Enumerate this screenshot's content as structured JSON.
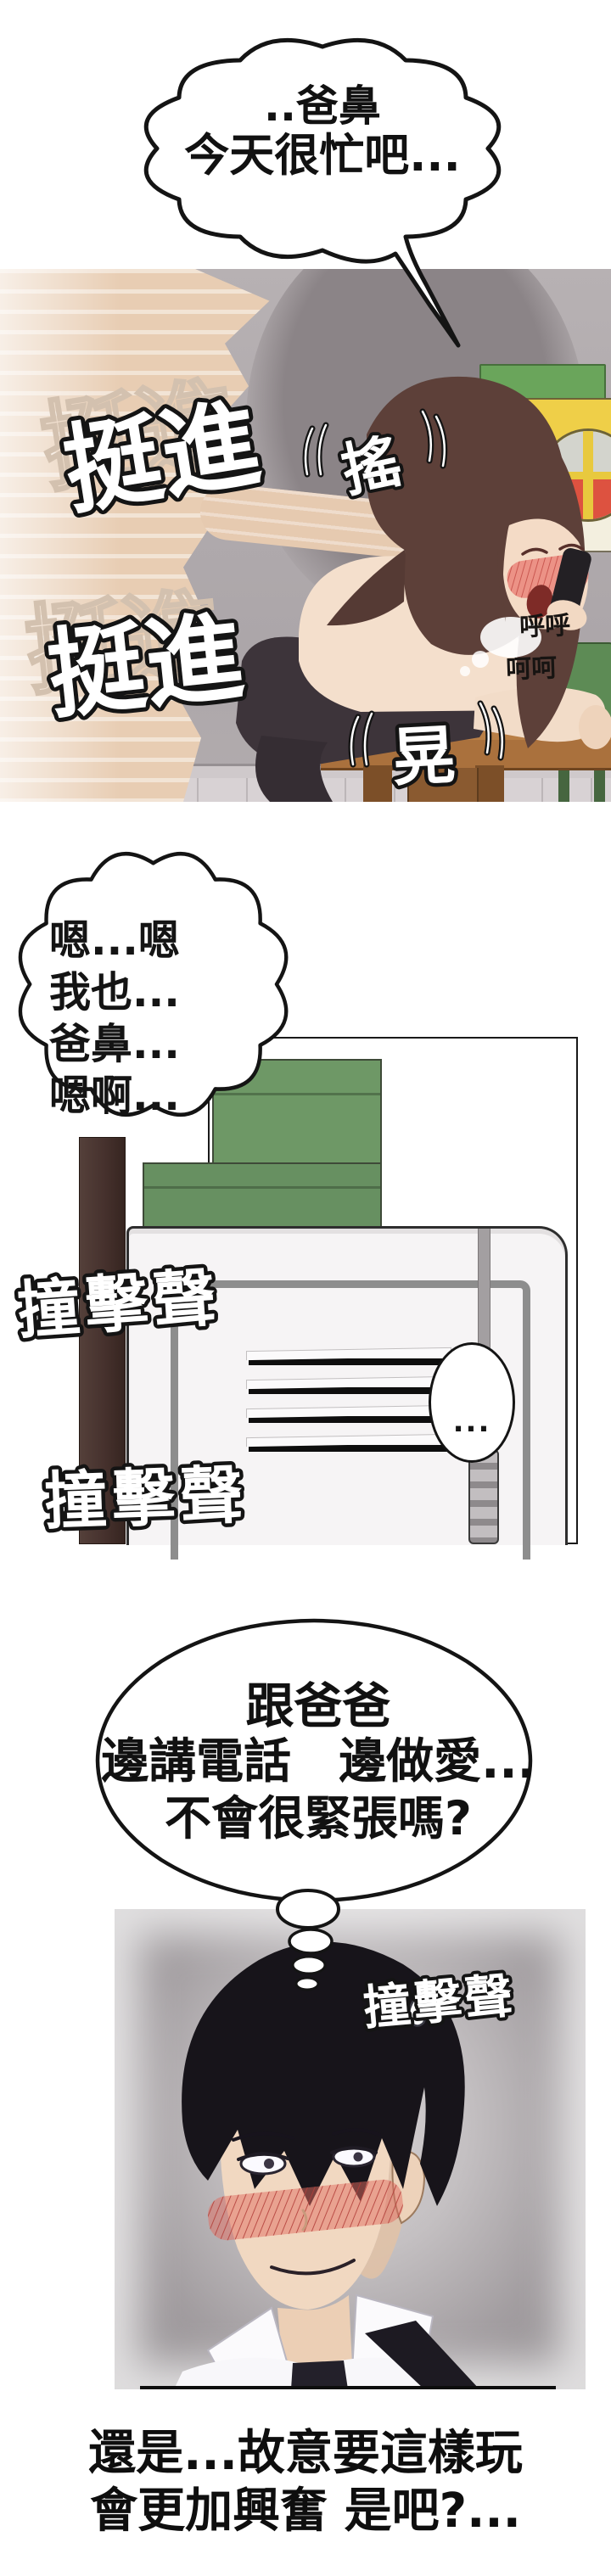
{
  "type": "comic-page",
  "bubbles": {
    "speech_top": {
      "line1": "..爸鼻",
      "line2": "今天很忙吧..."
    },
    "speech_moan": {
      "line1": "嗯...嗯",
      "line2": "我也...",
      "line3": "爸鼻...",
      "line4": "嗯啊..."
    },
    "ellipsis_oval": {
      "text": "..."
    },
    "thought": {
      "line1": "跟爸爸",
      "line2": "邊講電話　邊做愛...",
      "line3": "不會很緊張嗎?"
    }
  },
  "sfx": {
    "thrust_1": "挺進",
    "thrust_2": "挺進",
    "shake": "搖",
    "sway": "晃",
    "pant_soft_1": "呼呼",
    "pant_soft_2": "呵呵",
    "bang_1": "撞擊聲",
    "bang_2": "撞擊聲",
    "bang_3": "撞擊聲"
  },
  "caption": {
    "line1": "還是...故意要這樣玩",
    "line2": "會更加興奮 是吧?..."
  },
  "colors": {
    "page_bg": "#ffffff",
    "ink": "#141414",
    "panel1_wall": "#b2acae",
    "skin": "#ecd2b9",
    "hair_woman": "#5d4039",
    "hair_man": "#17141a",
    "table_wood": "#aa713d",
    "stocking": "#3d343a",
    "locker_green": "#6e9866",
    "pillar_brown": "#46312d",
    "door_white": "#f6f4f5",
    "chair_green": "#5d8b55",
    "cabinet_yellow": "#efcf48",
    "logo_orange": "#dd5240",
    "blush_red": "#e06a60"
  }
}
